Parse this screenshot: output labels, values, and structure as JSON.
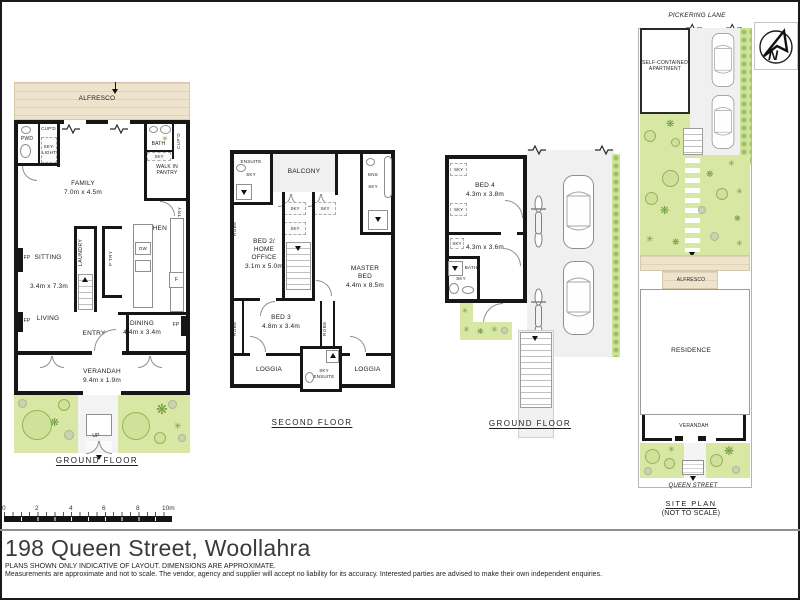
{
  "icons": {
    "plant": "✳",
    "fern": "❋"
  },
  "compass": {
    "north_label": "N"
  },
  "scale_bar": {
    "ticks": [
      "0",
      "2",
      "4",
      "6",
      "8",
      "10m"
    ]
  },
  "plan_ground_left": {
    "title": "GROUND FLOOR",
    "alfresco": "ALFRESCO",
    "pwd": "PWD",
    "cupd_top": "CUP'D",
    "skylight": "SKY-\nLIGHT",
    "bath": "BATH",
    "sky": "SKY",
    "cupd_right": "CUP'D",
    "walk_in_pantry": "WALK IN\nPANTRY",
    "ptry": "P'TRY",
    "family": "FAMILY",
    "family_dim": "7.0m x 4.5m",
    "kitchen": "KITCHEN",
    "dw": "DW",
    "fridge": "F",
    "laundry": "LAUNDRY",
    "sitting": "SITTING",
    "sitting_dim": "3.4m x 7.3m",
    "living": "LIVING",
    "entry": "ENTRY",
    "dining": "DINING",
    "dining_dim": "4.4m x 3.4m",
    "fp": "FP",
    "verandah": "VERANDAH",
    "verandah_dim": "9.4m x 1.9m",
    "up": "UP"
  },
  "plan_second_floor": {
    "title": "SECOND FLOOR",
    "ensuite": "ENSUITE",
    "sky": "SKY",
    "balcony": "BALCONY",
    "ens": "ENS",
    "robe": "ROBE",
    "bed2": "BED 2/\nHOME\nOFFICE",
    "bed2_dim": "3.1m x 5.0m",
    "master_bed": "MASTER\nBED",
    "master_bed_dim": "4.4m x 8.5m",
    "bed3": "BED 3",
    "bed3_dim": "4.8m x 3.4m",
    "loggia": "LOGGIA",
    "sky_ensuite": "SKY\nENSUITE"
  },
  "plan_ground_right": {
    "title": "GROUND FLOOR",
    "sky": "SKY",
    "bed4": "BED 4",
    "bed4_dim": "4.3m x 3.8m",
    "room_dim": "4.3m x 3.6m",
    "bath": "BATH"
  },
  "site_plan": {
    "title": "SITE PLAN",
    "subtitle": "(NOT TO SCALE)",
    "pickering_lane": "PICKERING LANE",
    "apartment": "SELF-CONTAINED\nAPARTMENT",
    "alfresco": "ALFRESCO",
    "residence": "RESIDENCE",
    "verandah": "VERANDAH",
    "queen_street": "QUEEN STREET"
  },
  "footer": {
    "address": "198 Queen Street, Woollahra",
    "disclaimer_line1": "PLANS SHOWN ONLY INDICATIVE OF LAYOUT. DIMENSIONS ARE APPROXIMATE.",
    "disclaimer_line2": "Measurements are approximate and not to scale. The vendor, agency and supplier will accept no liability for its accuracy. Interested parties are advised to make their own independent enquiries."
  }
}
